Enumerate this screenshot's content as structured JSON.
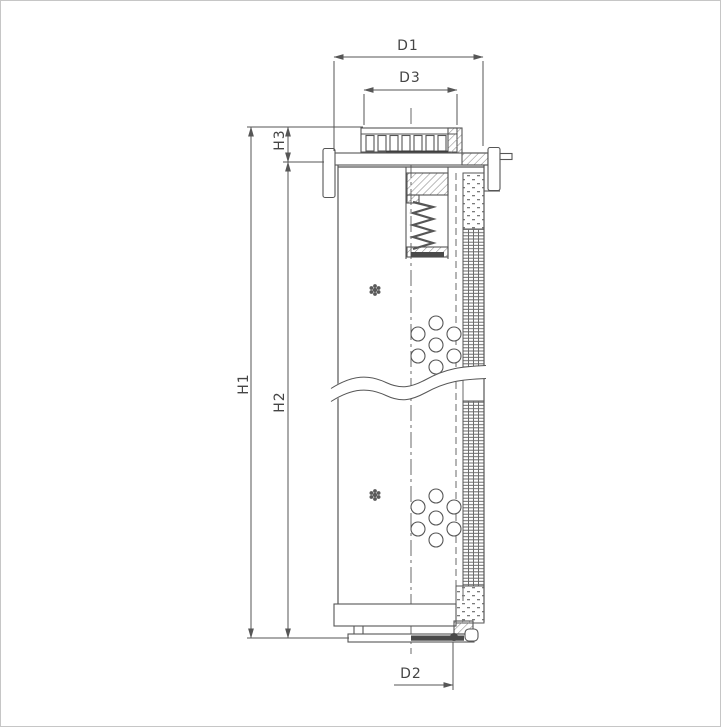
{
  "drawing": {
    "title": "filter-element-cross-section",
    "labels": {
      "d1": "D1",
      "d3": "D3",
      "h1": "H1",
      "h2": "H2",
      "h3": "H3",
      "d2": "D2"
    },
    "colors": {
      "line": "#565656",
      "dark_fill": "#3f3f3f",
      "hatch": "#8a8a8a",
      "background": "#ffffff",
      "page_border": "#c6c6c6"
    }
  }
}
